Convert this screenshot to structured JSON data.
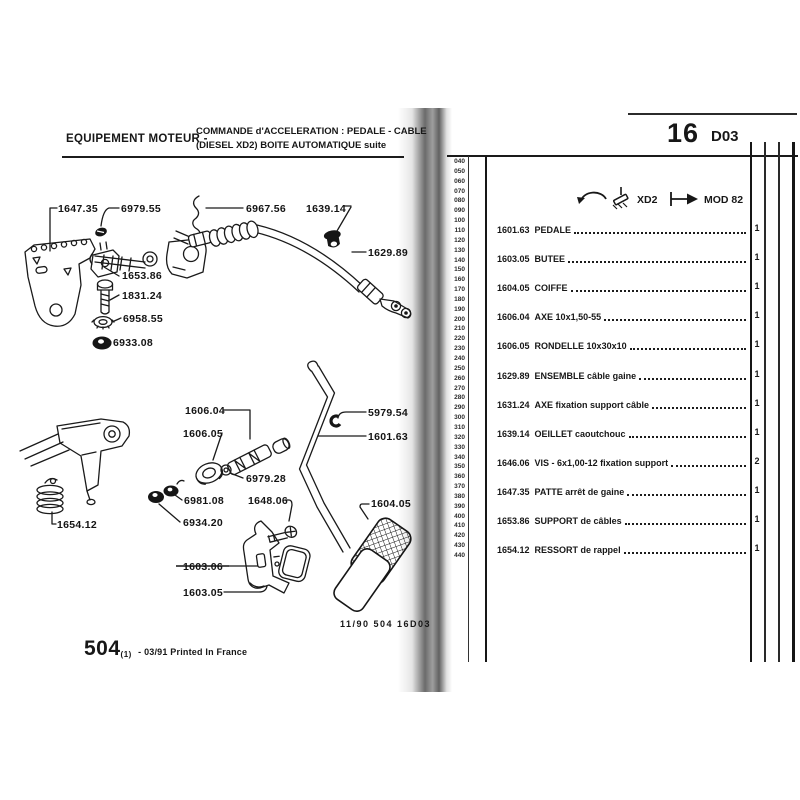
{
  "colors": {
    "ink": "#171717",
    "scan_shadow": "#6e6e6e"
  },
  "left_page": {
    "header": {
      "section": "EQUIPEMENT MOTEUR -",
      "title_line1": "COMMANDE d'ACCELERATION : PEDALE - CABLE",
      "title_line2": "(DIESEL XD2) BOITE AUTOMATIQUE suite"
    },
    "labels": [
      {
        "text": "1647.35"
      },
      {
        "text": "6979.55"
      },
      {
        "text": "6967.56"
      },
      {
        "text": "1639.14"
      },
      {
        "text": "1629.89"
      },
      {
        "text": "1653.86"
      },
      {
        "text": "1831.24"
      },
      {
        "text": "6958.55"
      },
      {
        "text": "6933.08"
      },
      {
        "text": "1606.04"
      },
      {
        "text": "1606.05"
      },
      {
        "text": "5979.54"
      },
      {
        "text": "1601.63"
      },
      {
        "text": "6979.28"
      },
      {
        "text": "6981.08"
      },
      {
        "text": "1648.06"
      },
      {
        "text": "6934.20"
      },
      {
        "text": "1604.05"
      },
      {
        "text": "1654.12"
      },
      {
        "text": "1603.06",
        "struck": true
      },
      {
        "text": "1603.05"
      }
    ],
    "footer": {
      "doc_ref": "11/90 504 16D03",
      "model": "504",
      "edition": "(1)",
      "print_note": "- 03/91 Printed In France"
    }
  },
  "right_page": {
    "page_number": "16",
    "page_code": "D03",
    "header_note": {
      "icons": [
        "rotation-arc-icon",
        "pedal-icon",
        "flow-arrow-icon"
      ],
      "engine": "XD2",
      "mod": "MOD 82"
    },
    "row_index": [
      "040",
      "050",
      "060",
      "070",
      "080",
      "090",
      "100",
      "110",
      "120",
      "130",
      "140",
      "150",
      "160",
      "170",
      "180",
      "190",
      "200",
      "210",
      "220",
      "230",
      "240",
      "250",
      "260",
      "270",
      "280",
      "290",
      "300",
      "310",
      "320",
      "330",
      "340",
      "350",
      "360",
      "370",
      "380",
      "390",
      "400",
      "410",
      "420",
      "430",
      "440"
    ],
    "parts": [
      {
        "ref": "1601.63",
        "desc": "PEDALE",
        "qty": "1"
      },
      {
        "ref": "1603.05",
        "desc": "BUTEE",
        "qty": "1"
      },
      {
        "ref": "1604.05",
        "desc": "COIFFE",
        "qty": "1"
      },
      {
        "ref": "1606.04",
        "desc": "AXE 10x1,50-55",
        "qty": "1"
      },
      {
        "ref": "1606.05",
        "desc": "RONDELLE 10x30x10",
        "qty": "1"
      },
      {
        "ref": "1629.89",
        "desc": "ENSEMBLE câble gaine",
        "qty": "1"
      },
      {
        "ref": "1631.24",
        "desc": "AXE fixation support câble",
        "qty": "1"
      },
      {
        "ref": "1639.14",
        "desc": "OEILLET caoutchouc",
        "qty": "1"
      },
      {
        "ref": "1646.06",
        "desc": "VIS - 6x1,00-12 fixation support",
        "qty": "2"
      },
      {
        "ref": "1647.35",
        "desc": "PATTE arrêt de gaine",
        "qty": "1"
      },
      {
        "ref": "1653.86",
        "desc": "SUPPORT de câbles",
        "qty": "1"
      },
      {
        "ref": "1654.12",
        "desc": "RESSORT de rappel",
        "qty": "1"
      }
    ]
  }
}
